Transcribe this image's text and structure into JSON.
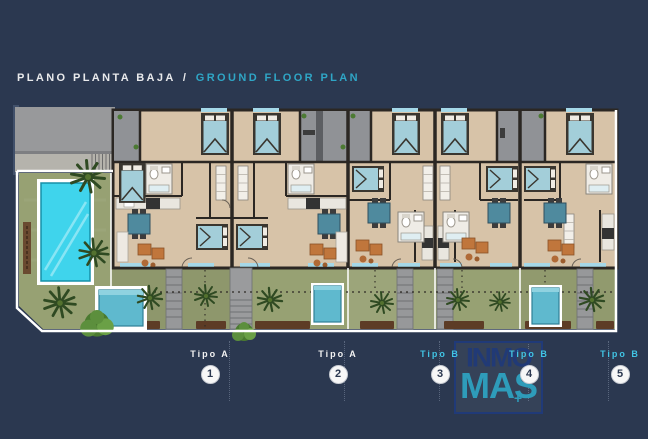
{
  "title": {
    "es": "PLANO PLANTA BAJA",
    "sep": "/",
    "en": "GROUND FLOOR PLAN"
  },
  "units": [
    {
      "label": "Tipo A",
      "number": "1",
      "type": "A"
    },
    {
      "label": "Tipo A",
      "number": "2",
      "type": "A"
    },
    {
      "label": "Tipo B",
      "number": "3",
      "type": "B"
    },
    {
      "label": "Tipo B",
      "number": "4",
      "type": "B"
    },
    {
      "label": "Tipo B",
      "number": "5",
      "type": "B"
    }
  ],
  "watermark": {
    "line1": "INMO",
    "line2": "MAS",
    "plus": "+"
  },
  "colors": {
    "background": "#2b3850",
    "title_primary": "#e9eaec",
    "title_accent": "#2fa6c6",
    "tipo_a_label": "#f2f2f2",
    "tipo_b_label": "#41c4e4",
    "badge_bg": "#f7f7f7",
    "badge_text": "#2b3850",
    "lawn": "#97a173",
    "pool_water": "#3fd4ec",
    "small_pool_water": "#5fb9ce",
    "floor": "#d7c3a8",
    "wall": "#2b2723",
    "terrace": "#909296",
    "bed": "#a3ced9",
    "table": "#4f8a9e",
    "sofa": "#c0763c",
    "palm": "#2f4a22",
    "mulch": "#5d3c26",
    "sill": "#a5d8e8",
    "boundary": "#ffffff",
    "logo_dark": "#203a78",
    "logo_teal": "#2e9cba"
  }
}
